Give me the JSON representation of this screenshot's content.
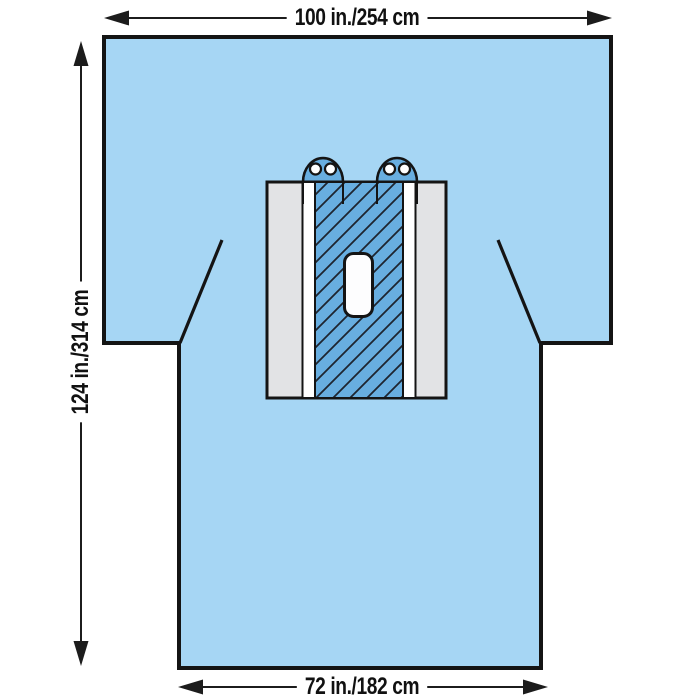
{
  "diagram": {
    "subject": "surgical-drape-with-fenestration",
    "dimension_labels": {
      "top_width": "100 in./254 cm",
      "left_height": "124 in./314 cm",
      "bottom_width": "72 in./182 cm"
    },
    "parts": {
      "drape_body": "t-shaped-drape",
      "reinforcement_panel": "hatched-reinforcement-panel",
      "side_strips": "gray-and-white-side-strips",
      "fenestration": "rounded-rect-fenestration",
      "tube_holders": "two-dome-tube-holders-with-eyelets",
      "shoulder_slits": "angled-shoulder-slits"
    },
    "colors": {
      "background": "#ffffff",
      "drape_fill": "#a6d6f4",
      "panel_hatch_fill": "#68aee0",
      "hatch_line": "#1e2530",
      "strip_gray": "#e2e3e5",
      "strip_white": "#ffffff",
      "fenestration_fill": "#fdfdfe",
      "outline": "#141414",
      "arrow": "#1c1c1c"
    }
  }
}
